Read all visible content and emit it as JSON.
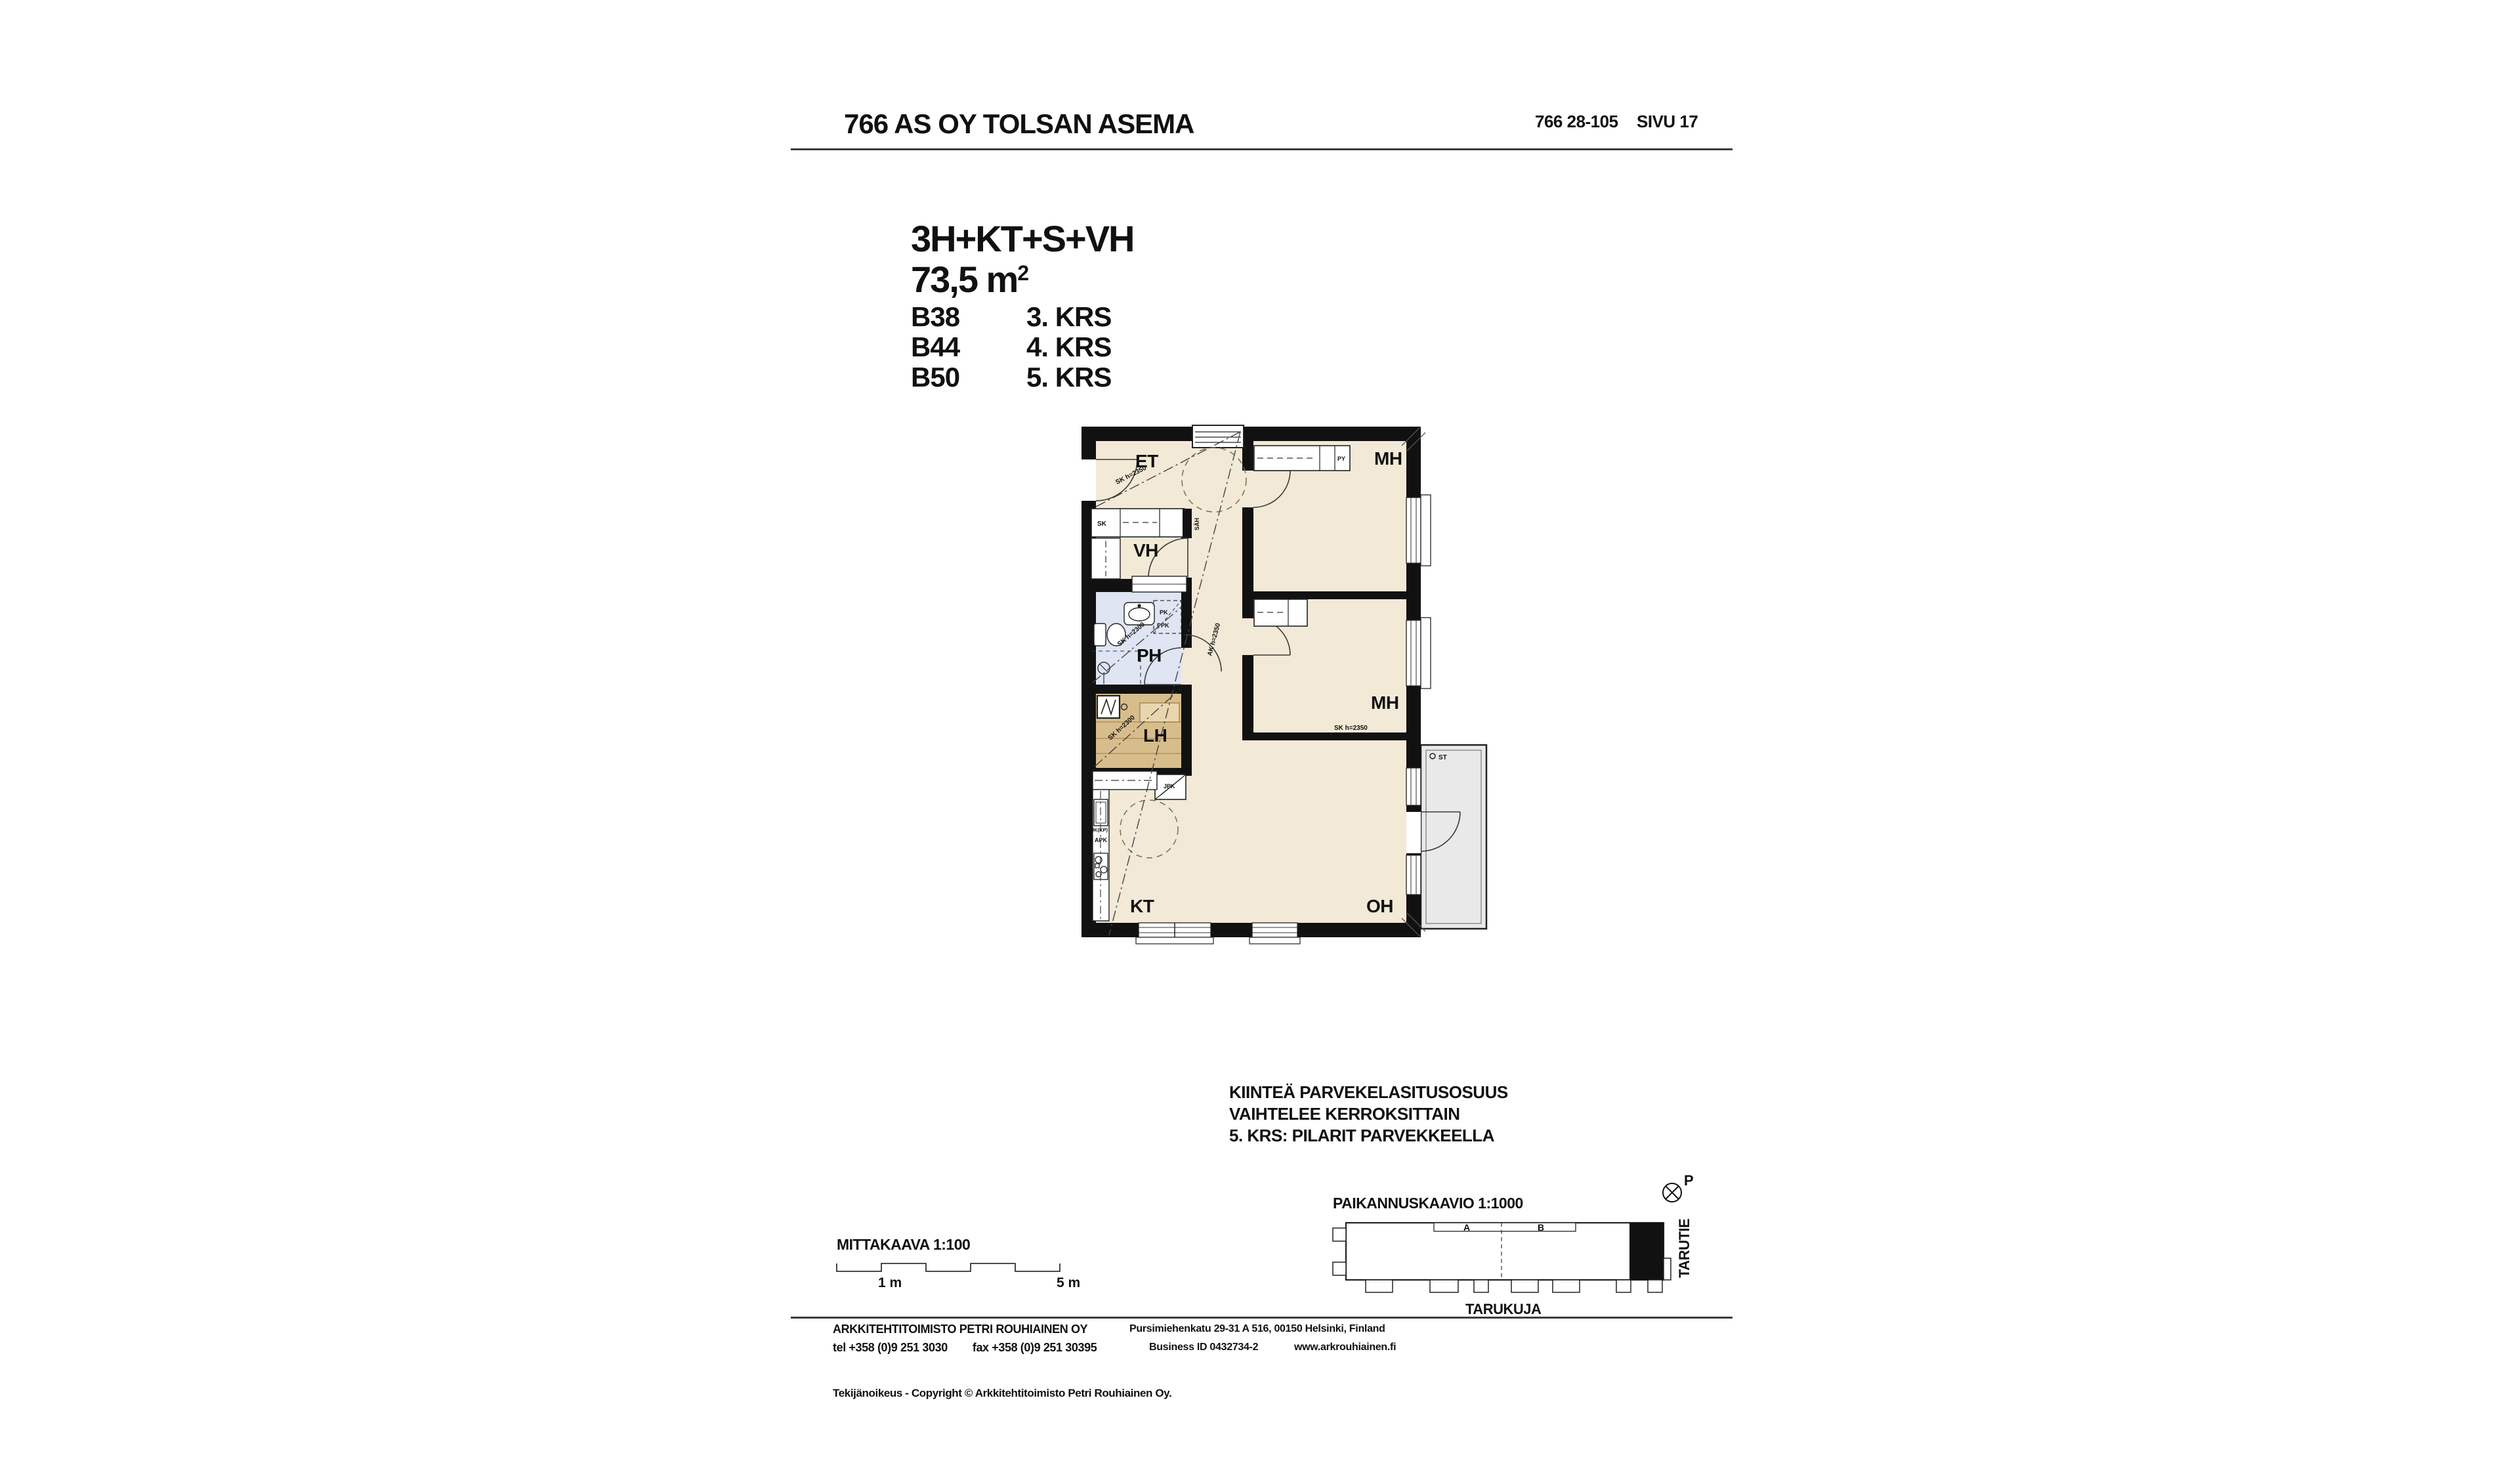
{
  "header": {
    "project_title": "766 AS OY TOLSAN ASEMA",
    "document_number": "766 28-105",
    "page_label": "SIVU 17"
  },
  "apartment_info": {
    "type_label": "3H+KT+S+VH",
    "area_value": "73,5 m",
    "area_exponent": "2",
    "units": [
      {
        "unit_id": "B38",
        "floor": "3. KRS"
      },
      {
        "unit_id": "B44",
        "floor": "4. KRS"
      },
      {
        "unit_id": "B50",
        "floor": "5. KRS"
      }
    ]
  },
  "floor_plan": {
    "rooms": {
      "entry": "ET",
      "bedroom1": "MH",
      "walk_in_closet": "VH",
      "bathroom": "PH",
      "sauna": "LH",
      "bedroom2": "MH",
      "kitchen": "KT",
      "living_room": "OH"
    },
    "marks": {
      "wardrobe": "SK",
      "linen_closet": "PY",
      "electrical": "SÄH",
      "washer": "PK",
      "dryer": "PPK",
      "fridge": "JK(KP)",
      "dishwasher": "APK",
      "cleaning_closet": "JPK",
      "balcony_mark": "ST"
    },
    "height_notes": {
      "sk2350": "SK h=2350",
      "ak2350": "AK h=2350",
      "sk2300": "SK h=2300"
    }
  },
  "notes_block": {
    "line1": "KIINTEÄ PARVEKELASITUSOSUUS",
    "line2": "VAIHTELEE KERROKSITTAIN",
    "line3": "5. KRS: PILARIT PARVEKKEELLA"
  },
  "scale_bar": {
    "label": "MITTAKAAVA 1:100",
    "start_label": "1 m",
    "end_label": "5 m"
  },
  "site_diagram": {
    "label": "PAIKANNUSKAAVIO 1:1000",
    "stair_a": "A",
    "stair_b": "B",
    "street_bottom": "TARUKUJA",
    "street_right": "TARUTIE",
    "north_label": "P"
  },
  "footer": {
    "company": "ARKKITEHTITOIMISTO PETRI ROUHIAINEN OY",
    "telephone": "tel +358 (0)9 251 3030",
    "fax": "fax +358 (0)9 251 30395",
    "address": "Pursimiehenkatu 29-31 A 516, 00150 Helsinki, Finland",
    "business_id": "Business ID 0432734-2",
    "website": "www.arkrouhiainen.fi",
    "copyright_line": "Tekijänoikeus - Copyright © Arkkitehtitoimisto Petri Rouhiainen Oy."
  },
  "colors": {
    "floor": "#f2e9d6",
    "wet_room": "#dfe5f3",
    "sauna": "#d8bd8c",
    "sauna_bench": "#e9d6ae",
    "balcony": "#e9e9e9",
    "wall": "#111111",
    "rule": "#3c3c3c"
  }
}
